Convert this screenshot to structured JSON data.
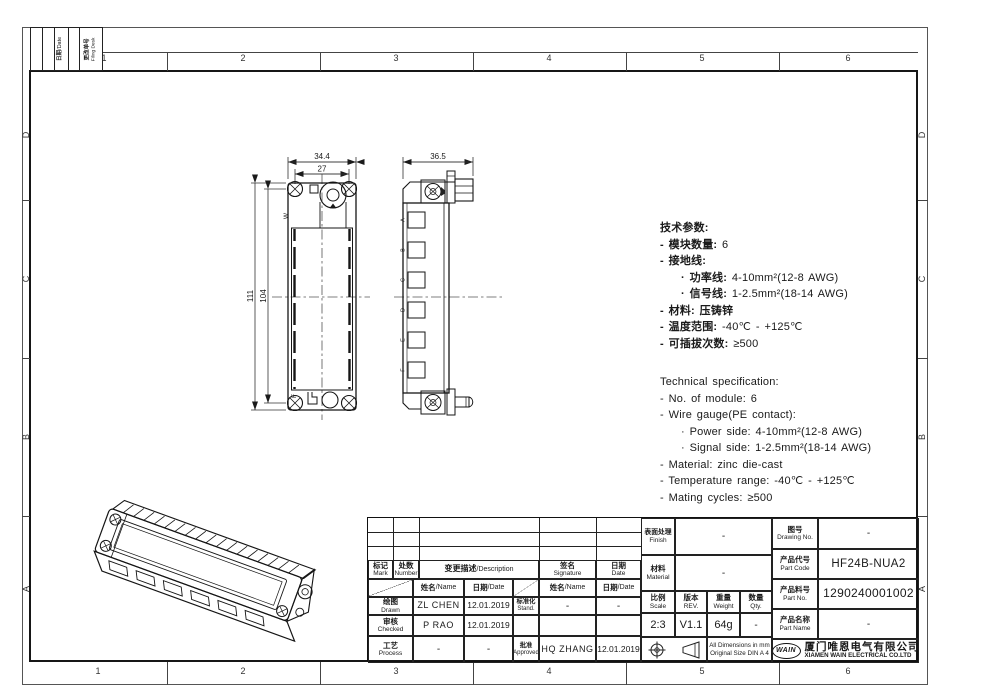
{
  "frame": {
    "top_zones": [
      "1",
      "2",
      "3",
      "4",
      "5",
      "6"
    ],
    "bottom_zones": [
      "1",
      "2",
      "3",
      "4",
      "5",
      "6"
    ],
    "left_zones": [
      "D",
      "C",
      "B",
      "A"
    ],
    "right_zones": [
      "D",
      "C",
      "B",
      "A"
    ],
    "corner_table": {
      "date_cn": "日期",
      "date_en": "/Date",
      "filing_cn": "更改单号",
      "filing_en": "Filing Desk"
    }
  },
  "views": {
    "front": {
      "dim_overall_width": "34.4",
      "dim_hole_pitch": "27",
      "dim_overall_height": "111",
      "dim_vert_pitch": "104",
      "mark_top": "W",
      "mark_bottom": "F"
    },
    "side": {
      "dim_depth": "36.5",
      "module_labels": [
        "A",
        "B",
        "C",
        "D",
        "E",
        "F"
      ]
    }
  },
  "tech_cn": {
    "lines": [
      {
        "b": "技术参数:",
        "r": ""
      },
      {
        "b": "- 模块数量:",
        "r": " 6"
      },
      {
        "b": "- 接地线:",
        "r": ""
      },
      {
        "b": "· 功率线:",
        "r": " 4-10mm²(12-8 AWG)"
      },
      {
        "b": "· 信号线:",
        "r": " 1-2.5mm²(18-14 AWG)"
      },
      {
        "b": "- 材料: 压铸锌",
        "r": ""
      },
      {
        "b": "- 温度范围:",
        "r": " -40℃ - +125℃"
      },
      {
        "b": "- 可插拔次数:",
        "r": " ≥500"
      }
    ]
  },
  "tech_en": {
    "lines": [
      "Technical specification:",
      "- No. of module: 6",
      "- Wire gauge(PE contact):",
      "· Power side: 4-10mm²(12-8 AWG)",
      "· Signal side: 1-2.5mm²(18-14 AWG)",
      "- Material: zinc die-cast",
      "- Temperature range: -40℃ - +125℃",
      "- Mating cycles: ≥500"
    ]
  },
  "titleblock": {
    "rev": {
      "mark_cn": "标记",
      "mark_en": "Mark",
      "number_cn": "处数",
      "number_en": "Number",
      "desc_cn": "变更描述",
      "desc_en": "/Description",
      "sig_cn": "签名",
      "sig_en": "Signature",
      "date_cn": "日期",
      "date_en": "Date"
    },
    "sub": {
      "name_cn": "姓名",
      "name_en": "/Name",
      "date_cn": "日期",
      "date_en": "/Date"
    },
    "rows": {
      "drawn": {
        "cn": "绘图",
        "en": "Drawn",
        "name": "ZL CHEN",
        "date": "12.01.2019"
      },
      "checked": {
        "cn": "审核",
        "en": "Checked",
        "name": "P RAO",
        "date": "12.01.2019"
      },
      "process": {
        "cn": "工艺",
        "en": "Process",
        "name": "-",
        "date": "-"
      },
      "stand": {
        "cn": "标准化",
        "en": "Stand.",
        "name": "-",
        "date": "-"
      },
      "approved": {
        "cn": "批准",
        "en": "Approved",
        "name": "HQ ZHANG",
        "date": "12.01.2019"
      }
    },
    "right": {
      "finish_cn": "表面处理",
      "finish_en": "Finish",
      "finish_val": "-",
      "material_cn": "材料",
      "material_en": "Material",
      "material_val": "-",
      "drawing_no_cn": "图号",
      "drawing_no_en": "Drawing No.",
      "drawing_no_val": "-",
      "part_code_cn": "产品代号",
      "part_code_en": "Part Code",
      "part_code_val": "HF24B-NUA2",
      "part_no_cn": "产品料号",
      "part_no_en": "Part No.",
      "part_no_val": "1290240001002",
      "part_name_cn": "产品名称",
      "part_name_en": "Part Name",
      "part_name_val": "-",
      "scale_cn": "比例",
      "scale_en": "Scale",
      "scale_val": "2:3",
      "rev_cn": "版本",
      "rev_en": "REV.",
      "rev_val": "V1.1",
      "weight_cn": "重量",
      "weight_en": "Weight",
      "weight_val": "64g",
      "qty_cn": "数量",
      "qty_en": "Qty.",
      "qty_val": "-",
      "note1": "All Dimensions in mm",
      "note2": "Original Size DIN A 4",
      "logo": "WAIN",
      "company_cn": "厦门唯恩电气有限公司",
      "company_en": "XIAMEN WAIN ELECTRICAL CO.LTD"
    }
  }
}
